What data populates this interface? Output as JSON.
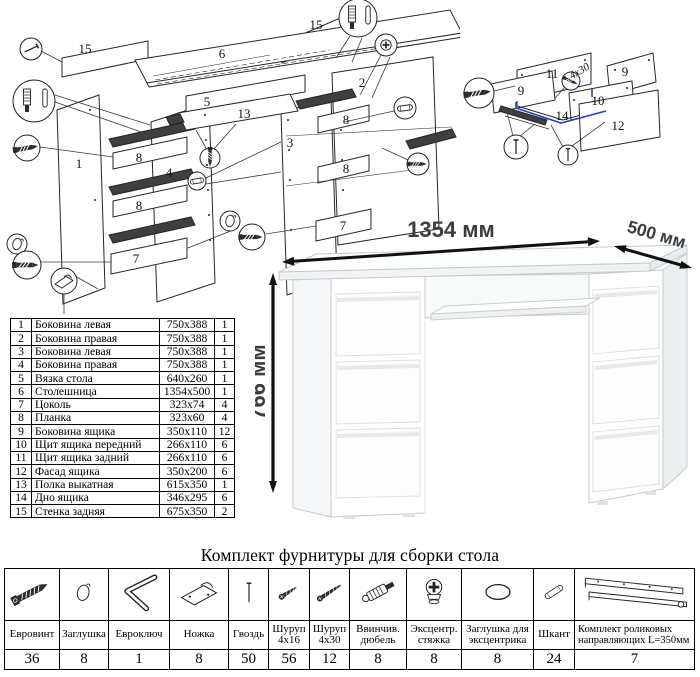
{
  "colors": {
    "ink": "#222222",
    "accent_blue": "#2440cc",
    "desk_outline": "#c5c9cc"
  },
  "main_diagram": {
    "labels": {
      "p15a": "15",
      "p6": "6",
      "p15b": "15",
      "p5": "5",
      "p13": "13",
      "p2": "2",
      "p3": "3",
      "p1": "1",
      "p4": "4",
      "p8a": "8",
      "p8b": "8",
      "p8c": "8",
      "p8d": "8",
      "p7a": "7",
      "p7b": "7"
    }
  },
  "drawer_diagram": {
    "labels": {
      "p11": "11",
      "p9a": "9",
      "p9b": "9",
      "p10": "10",
      "p14": "14",
      "p12": "12"
    },
    "screw_note": "4x30"
  },
  "desk_view": {
    "width_label": "1354 мм",
    "depth_label": "500 мм",
    "height_label": "766 мм"
  },
  "parts_table": {
    "rows": [
      {
        "num": "1",
        "name": "Боковина левая",
        "size": "750x388",
        "qty": "1"
      },
      {
        "num": "2",
        "name": "Боковина правая",
        "size": "750x388",
        "qty": "1"
      },
      {
        "num": "3",
        "name": "Боковина левая",
        "size": "750x388",
        "qty": "1"
      },
      {
        "num": "4",
        "name": "Боковина правая",
        "size": "750x388",
        "qty": "1"
      },
      {
        "num": "5",
        "name": "Вязка стола",
        "size": "640x260",
        "qty": "1"
      },
      {
        "num": "6",
        "name": "Столешница",
        "size": "1354x500",
        "qty": "1"
      },
      {
        "num": "7",
        "name": "Цоколь",
        "size": "323x74",
        "qty": "4"
      },
      {
        "num": "8",
        "name": "Планка",
        "size": "323x60",
        "qty": "4"
      },
      {
        "num": "9",
        "name": "Боковина ящика",
        "size": "350x110",
        "qty": "12"
      },
      {
        "num": "10",
        "name": "Щит ящика передний",
        "size": "266x110",
        "qty": "6"
      },
      {
        "num": "11",
        "name": "Щит ящика задний",
        "size": "266x110",
        "qty": "6"
      },
      {
        "num": "12",
        "name": "Фасад ящика",
        "size": "350x200",
        "qty": "6"
      },
      {
        "num": "13",
        "name": "Полка выкатная",
        "size": "615x350",
        "qty": "1"
      },
      {
        "num": "14",
        "name": "Дно ящика",
        "size": "346x295",
        "qty": "6"
      },
      {
        "num": "15",
        "name": "Стенка задняя",
        "size": "675x350",
        "qty": "2"
      }
    ]
  },
  "hardware": {
    "title": "Комплект фурнитуры для сборки стола",
    "items": [
      {
        "icon": "euro-screw-icon",
        "name": "Евровинт",
        "qty": "36"
      },
      {
        "icon": "furniture-cap-icon",
        "name": "Заглушка",
        "qty": "8"
      },
      {
        "icon": "hex-key-icon",
        "name": "Евроключ",
        "qty": "1"
      },
      {
        "icon": "furniture-foot-icon",
        "name": "Ножка",
        "qty": "8"
      },
      {
        "icon": "nail-icon",
        "name": "Гвоздь",
        "qty": "50"
      },
      {
        "icon": "screw-4x16-icon",
        "name": "Шуруп 4x16",
        "qty": "56"
      },
      {
        "icon": "screw-4x30-icon",
        "name": "Шуруп 4x30",
        "qty": "12"
      },
      {
        "icon": "screw-in-dowel-icon",
        "name": "Ввинчив. дюбель",
        "qty": "8"
      },
      {
        "icon": "cam-lock-icon",
        "name": "Эксцентр. стяжка",
        "qty": "8"
      },
      {
        "icon": "cam-cap-icon",
        "name": "Заглушка для эксцентрика",
        "qty": "8"
      },
      {
        "icon": "wood-dowel-icon",
        "name": "Шкант",
        "qty": "24"
      },
      {
        "icon": "drawer-slides-icon",
        "name": "Комплект роликовых направляющих L=350мм",
        "qty": "7"
      }
    ]
  }
}
